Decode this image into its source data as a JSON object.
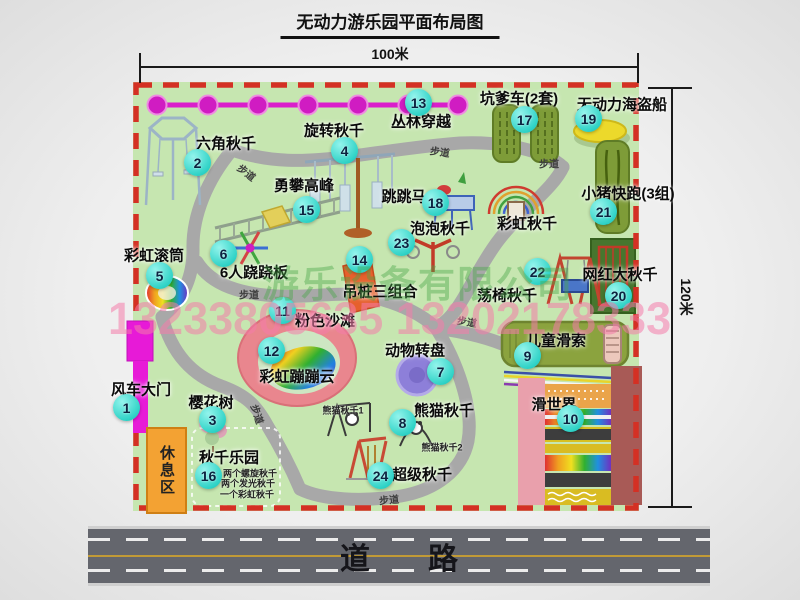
{
  "title": "无动力游乐园平面布局图",
  "dimensions": {
    "width": "100米",
    "height": "120米"
  },
  "road": {
    "label": "道路"
  },
  "watermark": {
    "company": "游乐设备有限公司",
    "phone": "13233805635 13202178333"
  },
  "rest_area": {
    "label": "休息区"
  },
  "rainbow_swing_label": "彩虹秋千",
  "path_label": "步道",
  "attractions": [
    {
      "num": "1",
      "name": "风车大门"
    },
    {
      "num": "2",
      "name": "六角秋千"
    },
    {
      "num": "3",
      "name": "樱花树"
    },
    {
      "num": "4",
      "name": "旋转秋千"
    },
    {
      "num": "5",
      "name": "彩虹滚筒"
    },
    {
      "num": "6",
      "name": "6人跷跷板"
    },
    {
      "num": "7",
      "name": "动物转盘"
    },
    {
      "num": "8",
      "name": "熊猫秋千",
      "subs": [
        "熊猫秋千1",
        "熊猫秋千2"
      ]
    },
    {
      "num": "9",
      "name": "儿童滑索"
    },
    {
      "num": "10",
      "name": "滑世界"
    },
    {
      "num": "11",
      "name": "粉色沙滩"
    },
    {
      "num": "12",
      "name": "彩虹蹦蹦云"
    },
    {
      "num": "13",
      "name": "丛林穿越"
    },
    {
      "num": "14",
      "name": "吊桩三组合"
    },
    {
      "num": "15",
      "name": "勇攀高峰"
    },
    {
      "num": "16",
      "name": "秋千乐园",
      "subs": [
        "两个螺旋秋千",
        "两个发光秋千",
        "一个彩虹秋千"
      ]
    },
    {
      "num": "17",
      "name": "坑爹车(2套)"
    },
    {
      "num": "18",
      "name": "跳跳马"
    },
    {
      "num": "19",
      "name": "无动力海盗船"
    },
    {
      "num": "20",
      "name": "网红大秋千"
    },
    {
      "num": "21",
      "name": "小猪快跑(3组)"
    },
    {
      "num": "22",
      "name": "荡椅秋千"
    },
    {
      "num": "23",
      "name": "泡泡秋千"
    },
    {
      "num": "24",
      "name": "超级秋千"
    }
  ],
  "colors": {
    "park_green": "#c6e6b0",
    "border_red": "#d43024",
    "path_gray": "#a8a8a8",
    "badge_teal": "#2fd8cc",
    "zipline_magenta": "#da1ecb",
    "gate_magenta": "#e71ad7",
    "rest_area_orange": "#f3a233",
    "road_gray": "#64666d",
    "watermark_green": "#48a848",
    "watermark_pink": "#f47caa"
  }
}
